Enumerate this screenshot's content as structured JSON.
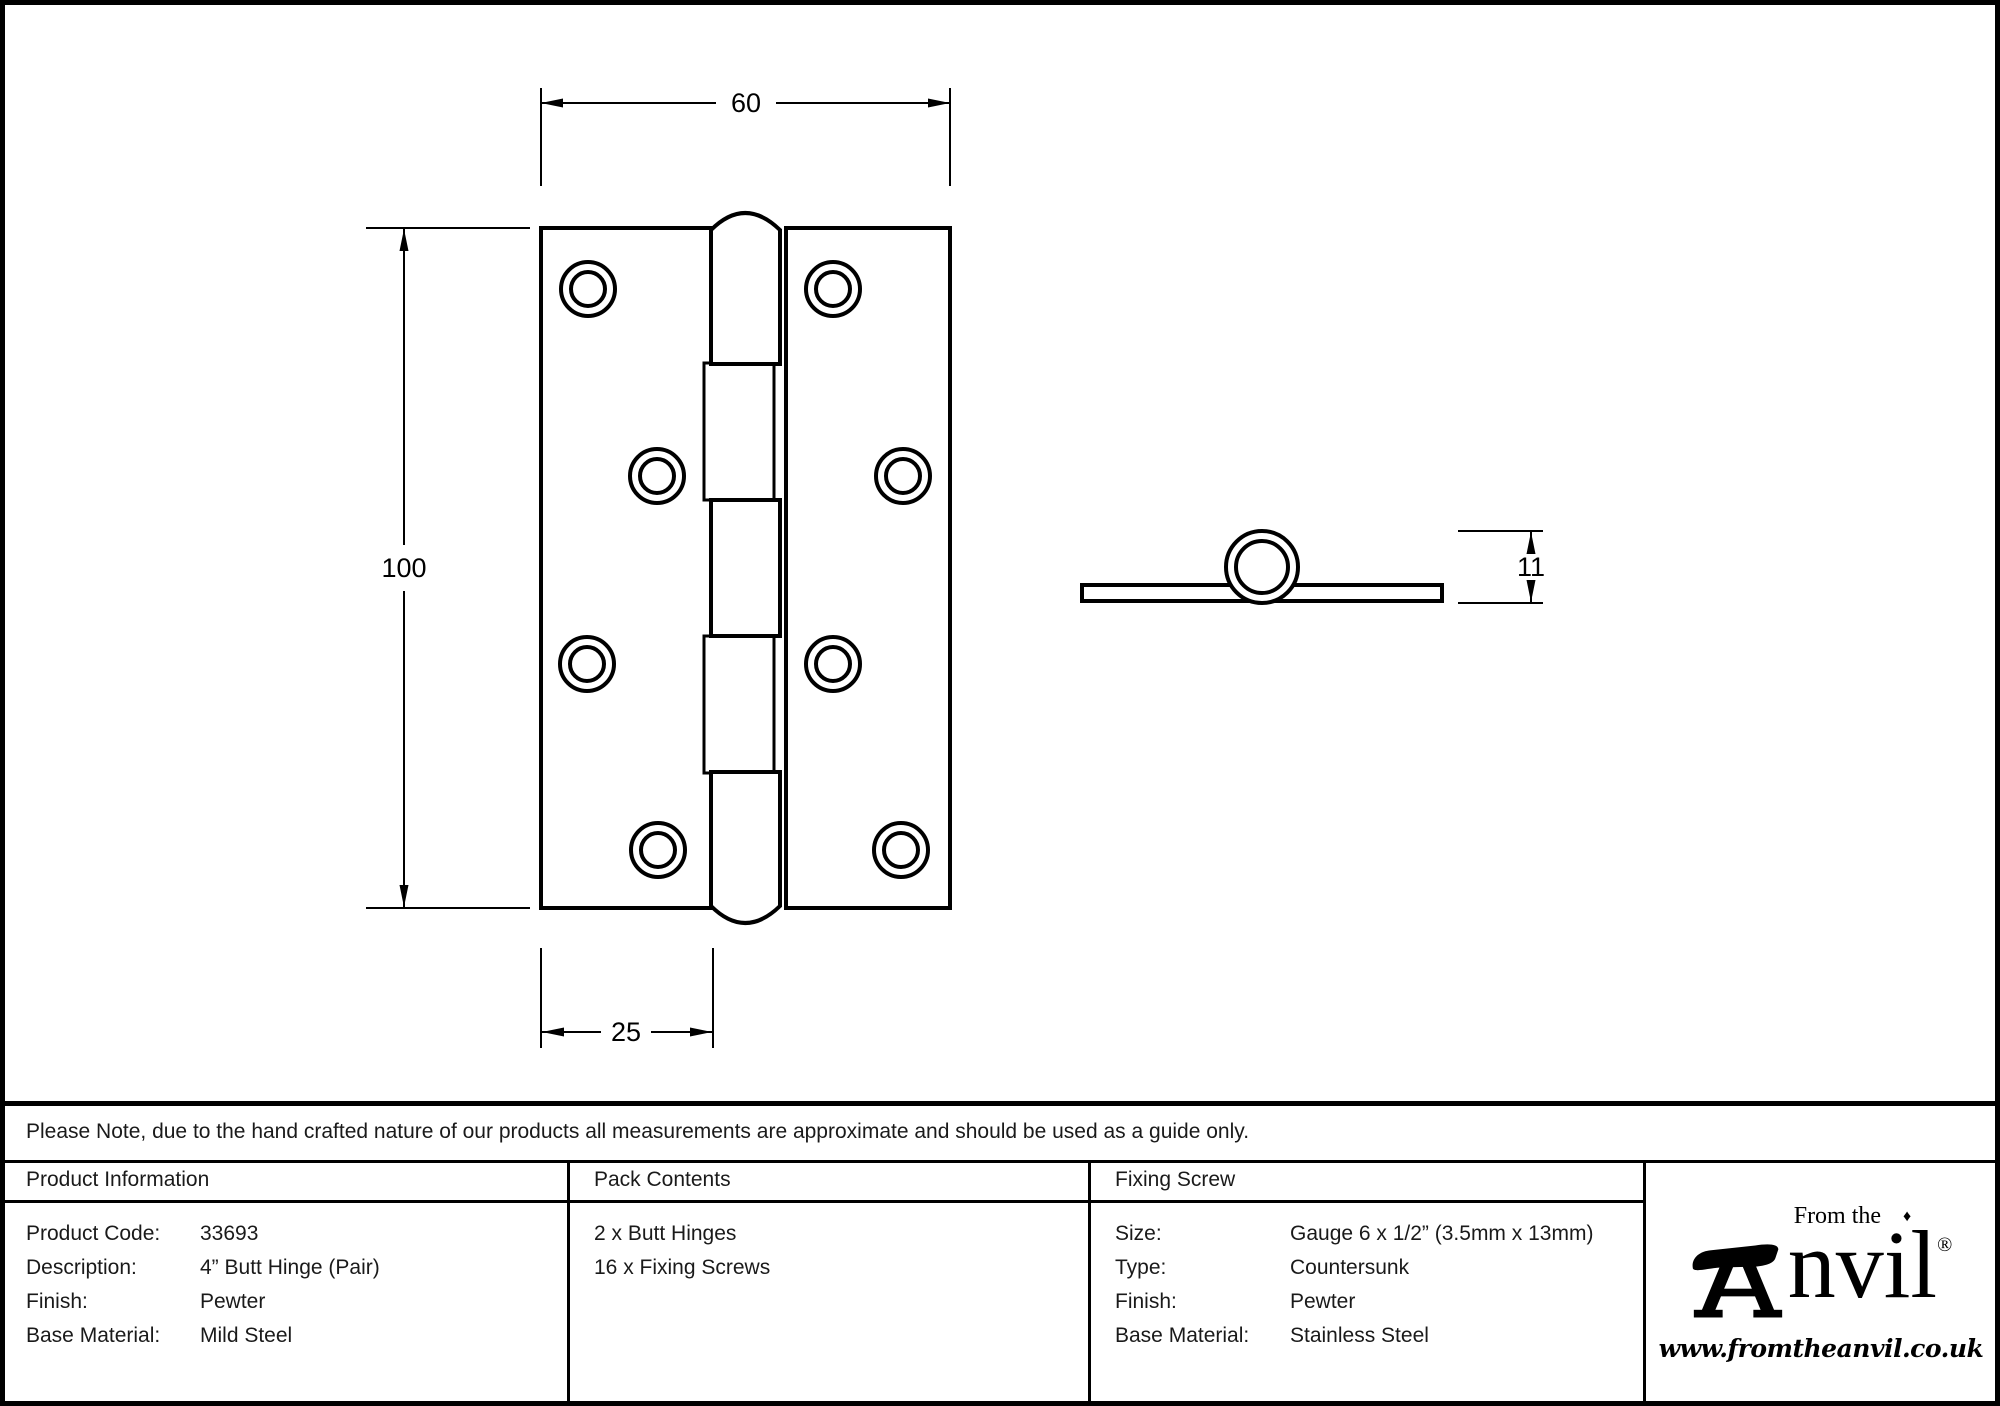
{
  "sheet": {
    "background": "#ffffff",
    "ink": "#000000"
  },
  "drawing": {
    "front_view": {
      "width_label": "60",
      "height_label": "100",
      "leaf_width_label": "25"
    },
    "side_view": {
      "thickness_label": "11"
    }
  },
  "note": {
    "text": "Please Note, due to the hand crafted nature of our products all measurements are approximate and should be used as a guide only."
  },
  "table": {
    "product_information": {
      "header": "Product Information",
      "rows": [
        {
          "label": "Product Code:",
          "value": "33693"
        },
        {
          "label": "Description:",
          "value": "4” Butt Hinge (Pair)"
        },
        {
          "label": "Finish:",
          "value": "Pewter"
        },
        {
          "label": "Base Material:",
          "value": "Mild Steel"
        }
      ]
    },
    "pack_contents": {
      "header": "Pack Contents",
      "items": [
        "2 x Butt Hinges",
        "16 x Fixing Screws"
      ]
    },
    "fixing_screw": {
      "header": "Fixing Screw",
      "rows": [
        {
          "label": "Size:",
          "value": "Gauge 6 x 1/2” (3.5mm x 13mm)"
        },
        {
          "label": "Type:",
          "value": "Countersunk"
        },
        {
          "label": "Finish:",
          "value": "Pewter"
        },
        {
          "label": "Base Material:",
          "value": "Stainless Steel"
        }
      ]
    }
  },
  "logo": {
    "tagline": "From the",
    "diamond": "♦",
    "name_rest": "nvil",
    "registered": "®",
    "website": "www.fromtheanvil.co.uk"
  }
}
